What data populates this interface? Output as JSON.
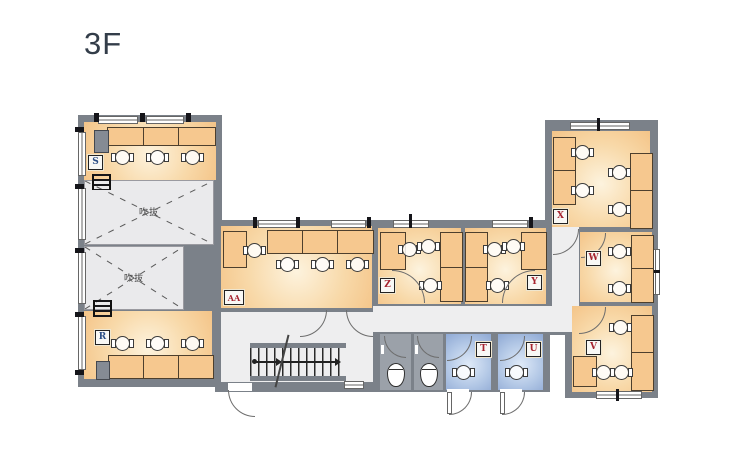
{
  "title": "3F",
  "rooms": [
    {
      "id": "s",
      "label": "S",
      "badge_color": "blue"
    },
    {
      "id": "r",
      "label": "R",
      "badge_color": "blue"
    },
    {
      "id": "aa",
      "label": "AA",
      "badge_color": "red"
    },
    {
      "id": "z",
      "label": "Z",
      "badge_color": "red"
    },
    {
      "id": "y",
      "label": "Y",
      "badge_color": "red"
    },
    {
      "id": "x",
      "label": "X",
      "badge_color": "red"
    },
    {
      "id": "w",
      "label": "W",
      "badge_color": "red"
    },
    {
      "id": "v",
      "label": "V",
      "badge_color": "red"
    },
    {
      "id": "t",
      "label": "T",
      "badge_color": "red"
    },
    {
      "id": "u",
      "label": "U",
      "badge_color": "red"
    }
  ],
  "voids": [
    {
      "label": "吹抜"
    },
    {
      "label": "吹抜"
    }
  ],
  "colors": {
    "wall": "#7b8189",
    "corridor": "#eeeeef",
    "voidfill": "#eaeaec",
    "stall": "#9ba1a9",
    "badge_red": "#a6242f",
    "badge_blue": "#2c4f86",
    "desk": "#f6c88f",
    "title": "#333d49"
  }
}
